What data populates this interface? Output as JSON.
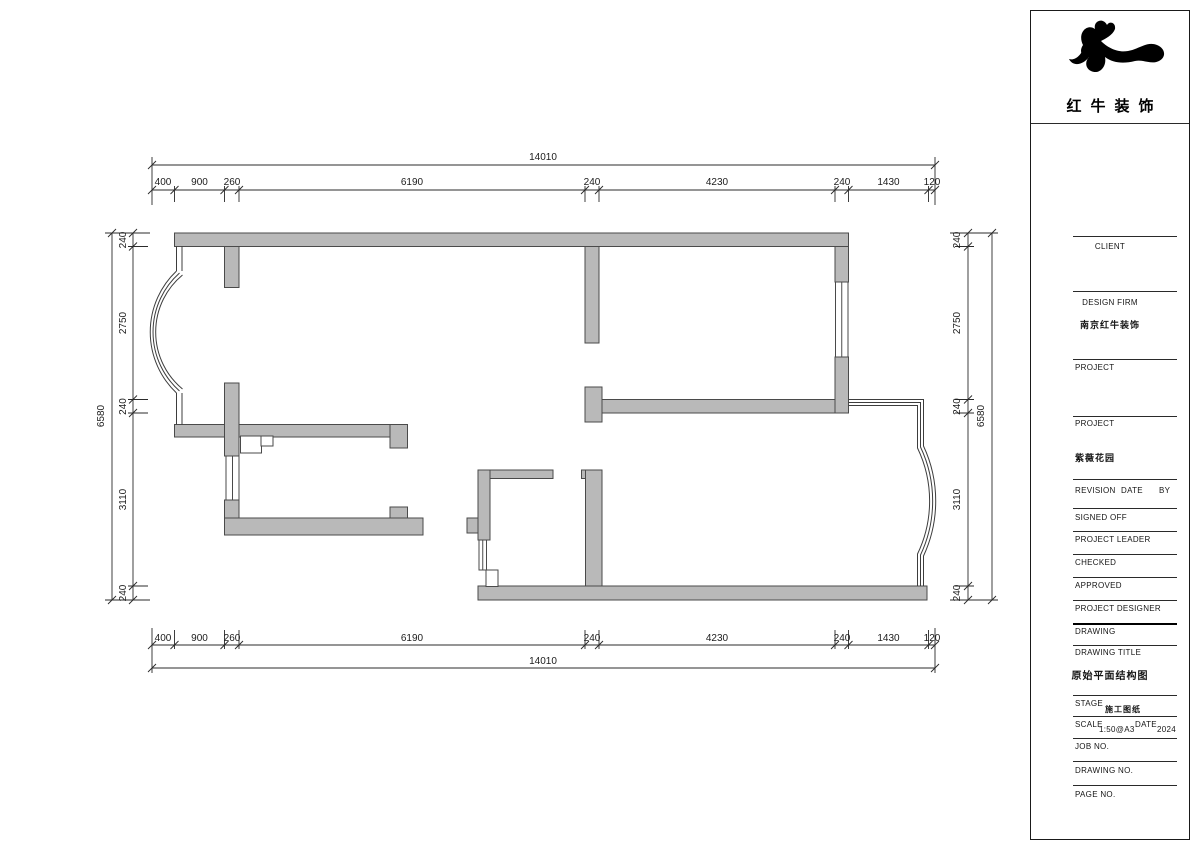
{
  "logo": {
    "company_name": "红牛装饰"
  },
  "north": {
    "label": "N"
  },
  "dimensions": {
    "top": {
      "overall": "14010",
      "segments": [
        "400",
        "900",
        "260",
        "6190",
        "240",
        "4230",
        "240",
        "1430",
        "120"
      ]
    },
    "bottom": {
      "overall": "14010",
      "segments": [
        "400",
        "900",
        "260",
        "6190",
        "240",
        "4230",
        "240",
        "1430",
        "120"
      ]
    },
    "left": {
      "overall": "6580",
      "segments": [
        "240",
        "2750",
        "240",
        "3110",
        "240"
      ]
    },
    "right": {
      "overall": "6580",
      "segments": [
        "240",
        "2750",
        "240",
        "3110",
        "240"
      ]
    }
  },
  "title_block": {
    "client_label": "CLIENT",
    "design_firm_label": "DESIGN FIRM",
    "design_firm_name": "南京红牛装饰",
    "project_label_1": "PROJECT",
    "project_label_2": "PROJECT",
    "project_name": "紫薇花园",
    "revision_label": "REVISION",
    "date_label": "DATE",
    "by_label": "BY",
    "signed_off_label": "SIGNED OFF",
    "project_leader_label": "PROJECT LEADER",
    "checked_label": "CHECKED",
    "approved_label": "APPROVED",
    "project_designer_label": "PROJECT DESIGNER",
    "drawing_label": "DRAWING",
    "drawing_title_label": "DRAWING TITLE",
    "drawing_title": "原始平面结构图",
    "stage_label": "STAGE",
    "stage_value": "施工图纸",
    "scale_label": "SCALE",
    "scale_value": "1:50@A3",
    "date_label_2": "DATE",
    "date_value": "2024",
    "job_no_label": "JOB NO.",
    "drawing_no_label": "DRAWING NO.",
    "page_no_label": "PAGE NO."
  },
  "colors": {
    "wall_fill": "#b9b9b9",
    "wall_stroke": "#4a4a4a",
    "line": "#2b2b2b"
  }
}
